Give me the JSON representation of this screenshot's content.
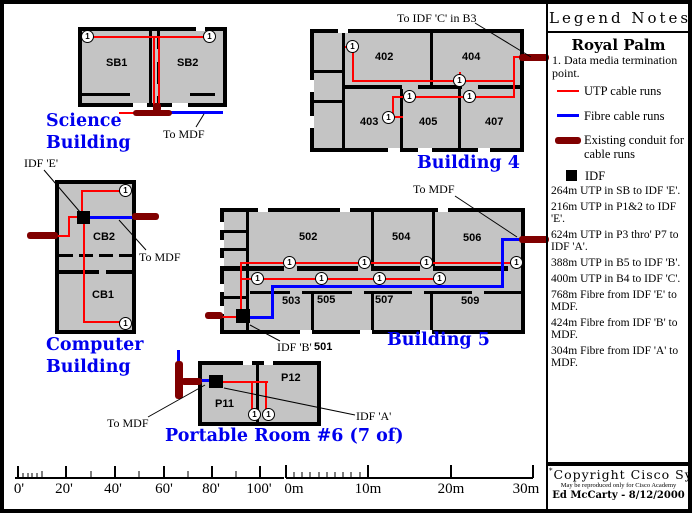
{
  "legend": {
    "title": "Legend Notes",
    "site": "Royal Palm",
    "note": "1. Data media termination point.",
    "items": [
      {
        "symbol": "utp-line",
        "label": "UTP cable runs"
      },
      {
        "symbol": "fibre-line",
        "label": "Fibre cable runs"
      },
      {
        "symbol": "conduit-bar",
        "label": "Existing conduit for cable runs"
      },
      {
        "symbol": "idf-square",
        "label": "IDF"
      }
    ],
    "cable_notes": [
      "264m UTP in SB to IDF 'E'.",
      "216m UTP in P1&2 to IDF 'E'.",
      "624m UTP in P3 thro' P7 to IDF 'A'.",
      "388m UTP in B5 to IDF 'B'.",
      "400m UTP in B4 to IDF 'C'.",
      "768m Fibre from IDF 'E' to MDF.",
      "424m Fibre from IDF 'B' to MDF.",
      "304m Fibre from IDF 'A' to MDF."
    ],
    "footer": {
      "footnote_mark": "*",
      "copyright": "Copyright Cisco Systems",
      "license": "May be reproduced only for Cisco Academy",
      "author": "Ed McCarty - 8/12/2000"
    }
  },
  "buildings": {
    "science": {
      "name": "Science Building",
      "rooms": [
        "SB1",
        "SB2"
      ],
      "to_mdf": "To MDF"
    },
    "building4": {
      "name": "Building 4",
      "rooms": [
        "402",
        "404",
        "403",
        "405",
        "407"
      ],
      "conduit_label": "To IDF 'C' in B3"
    },
    "computer": {
      "name": "Computer Building",
      "rooms": [
        "CB2",
        "CB1"
      ],
      "idf_label": "IDF 'E'",
      "to_mdf": "To MDF"
    },
    "building5": {
      "name": "Building 5",
      "rooms": [
        "502",
        "504",
        "506",
        "503",
        "505",
        "507",
        "509"
      ],
      "idf_room": "501",
      "idf_label": "IDF 'B'",
      "to_mdf": "To MDF"
    },
    "portable": {
      "name": "Portable Room #6 (7 of)",
      "rooms": [
        "P11",
        "P12"
      ],
      "idf_label": "IDF 'A'",
      "to_mdf": "To MDF"
    }
  },
  "symbols": {
    "termination_point": "1"
  },
  "scales": {
    "feet": [
      "0'",
      "20'",
      "40'",
      "60'",
      "80'",
      "100'"
    ],
    "meters": [
      "0m",
      "10m",
      "20m",
      "30m"
    ]
  },
  "colors": {
    "utp_cable": "#FF0000",
    "fibre_cable": "#0000FF",
    "conduit": "#800000",
    "room_fill": "#C4C4C4",
    "building_label": "#0000EE"
  }
}
